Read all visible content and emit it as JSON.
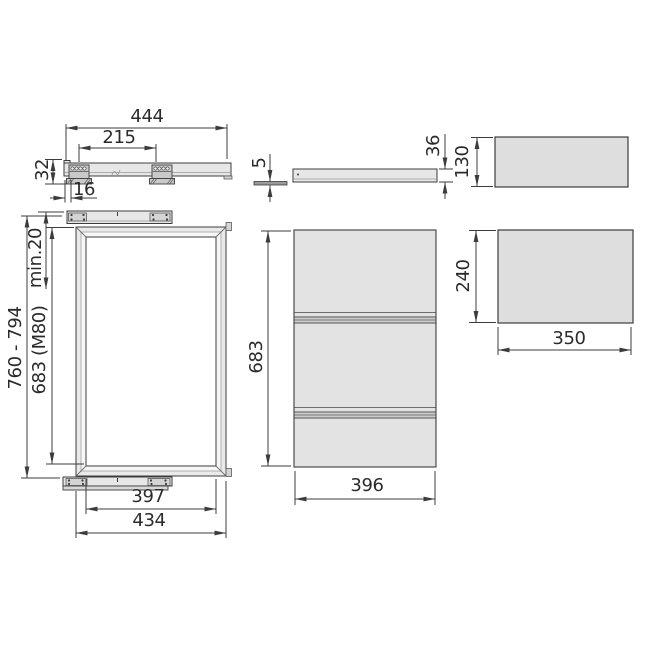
{
  "drawing_title": "pull-out-frame-technical-drawing",
  "dimensions": {
    "rail_length": "444",
    "rail_hole_spacing": "215",
    "rail_height": "32",
    "rail_front_offset": "16",
    "top_clearance": "min.20",
    "frame_height": "683 (M80)",
    "mounting_height_range": "760 - 794",
    "frame_inner_width": "397",
    "frame_outer_width": "434",
    "side_profile_thickness": "5",
    "side_profile_height": "36",
    "panel_height": "683",
    "panel_width": "396",
    "drawer_side_height": "130",
    "drawer_front_height": "240",
    "drawer_width": "350"
  },
  "colors": {
    "line": "#3c3c3c",
    "fill_metal": "#e7e7e7",
    "fill_bracket": "#c9c9c9",
    "fill_panel": "#e3e3e3",
    "fill_drawer": "#dedede"
  }
}
